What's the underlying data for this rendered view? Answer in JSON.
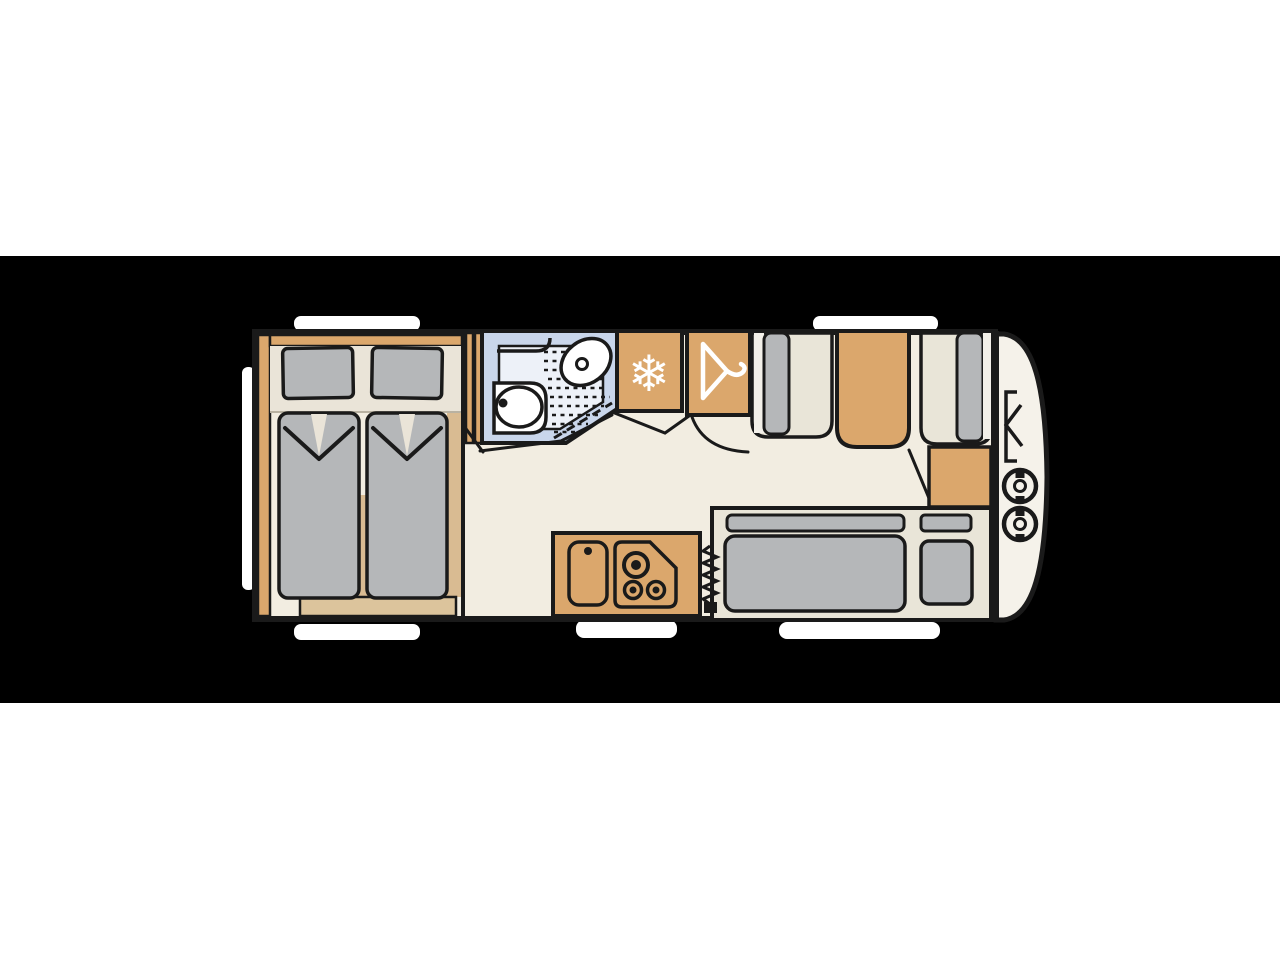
{
  "scene": {
    "kind": "caravan-floor-plan-illustration",
    "orientation": "side view from above, hitch to the right",
    "visible_text": "none"
  },
  "colors": {
    "page": "#ffffff",
    "band": "#000000",
    "outline": "#1a1a1a",
    "floor": "#f2ede1",
    "body": "#f5f2ea",
    "wood": "#dba76c",
    "wood_light": "#d9bb92",
    "foot_tan": "#dcc49c",
    "head": "#eae4d8",
    "cushion": "#b5b7b9",
    "cream_seat": "#e9e5d8",
    "white_strip": "#f3f0e9",
    "bath_wall": "#c9d6eb",
    "bath_floor": "#edf1f8",
    "white": "#ffffff",
    "icon": "#ffffff"
  },
  "icons": {
    "fridge_glyph": "❄",
    "fridge_icon": "snowflake-icon",
    "wardrobe_icon": "hanger-icon",
    "front_icons": "gas-bottle-icon x2"
  },
  "rooms": {
    "bedroom": {
      "name": "twin single beds with pillows",
      "position": "rear-left"
    },
    "bathroom": {
      "name": "washroom with toilet, basin and shower",
      "position": "mid-top"
    },
    "fridge": {
      "name": "refrigerator",
      "position": "top-centre"
    },
    "wardrobe": {
      "name": "wardrobe",
      "position": "top-centre-right"
    },
    "dinette": {
      "name": "two facing bench seats with table",
      "position": "front-top"
    },
    "kitchen": {
      "name": "kitchen with sink and 3-burner hob",
      "position": "bottom-centre"
    },
    "heater": {
      "name": "heater (zigzag symbol)",
      "position": "beside kitchen"
    },
    "sofa": {
      "name": "side sofa / single bed with pillow",
      "position": "front-bottom"
    },
    "gas_locker": {
      "name": "front locker with two gas bottles",
      "position": "front nose"
    }
  },
  "windows": {
    "count": 6,
    "style": "white rounded cut-outs on hull"
  }
}
